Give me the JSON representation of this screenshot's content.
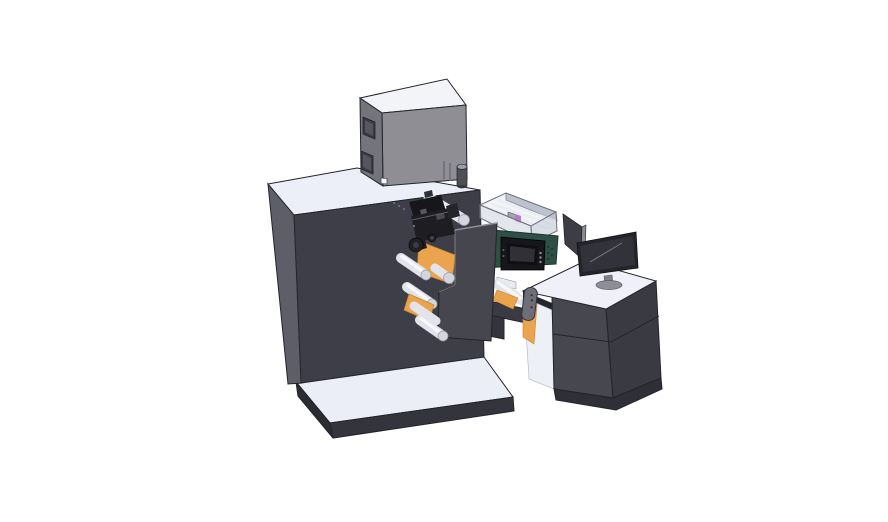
{
  "scene": {
    "type": "3d-cad-render",
    "description": "Isometric CAD render of a compact roll-fed label printing and converting machine: a large dark enclosure cabinet with web rollers and a print-head mechanism, a gray electronics box on top, a transparent guard module with linear rails over a teal control housing with an HMI touch panel, a web-transport bridge with an adjustment handle, and an operator desk cabinet with a desktop monitor, all standing on light base platforms.",
    "background": "#ffffff"
  },
  "colors": {
    "bg": "#ffffff",
    "outline": "#23232a",
    "cabinetFront": "#3e3e48",
    "cabinetSide": "#5e5e69",
    "cabinetTop": "#edeff8",
    "platformTop": "#eceef7",
    "platformSkirt": "#34343d",
    "platformSkirtDark": "#2b2b33",
    "boxTop": "#f3f4f8",
    "boxFront": "#8e8e94",
    "boxSide": "#74747b",
    "boxWindow": "#3a3a42",
    "boxWindowInner": "#565660",
    "boxVent": "#6e6e76",
    "beaconBody": "#4e4e57",
    "beaconTop": "#9aa0a8",
    "beaconBottom": "#3c3c44",
    "pillar": "#46464f",
    "pillarEdge": "#8f8f99",
    "roller": "#e3e4eb",
    "rollerHi": "#f7f8fc",
    "rollerCap": "#d4d5dd",
    "rollerEdge": "#9a9aa3",
    "orange": "#eaa44e",
    "orangeDark": "#c9812f",
    "green": "#2e4f45",
    "greenDark": "#1d332c",
    "greenTab": "#c8cdd6",
    "hmiFrame": "#17171b",
    "hmiBezel": "#101014",
    "hmiScreen": "#303036",
    "hmiButton": "#8a8a92",
    "mechDark": "#17171b",
    "mechMid": "#2f2f36",
    "mechLight": "#6b6b74",
    "encGlass": "#ccd3df",
    "encGlassSide": "#bfc7d4",
    "encBack": "#a9b1bd",
    "encRail": "#f4f6fa",
    "encFrame": "#70707a",
    "encCarriage": "#8f97a2",
    "encPurple": "#b558c6",
    "beamFill": "#3a3a43",
    "legFill": "#34343d",
    "deskTop": "#f0f1f8",
    "deskFrontLeft": "#474750",
    "deskFrontRight": "#3a3a43",
    "deskSkirt": "#2f2f37",
    "deskUnderside": "#26262e",
    "kickWhite": "#eef0f8",
    "monitorFrame": "#24242b",
    "monitorScreen": "#32323a",
    "monitorReflect": "#8a8a94",
    "monitorStand": "#80808a",
    "monitorBase": "#8e8e98",
    "panelDark": "#3d3d46",
    "panelSliver": "#8b8b94",
    "handleFill": "#6e6e77",
    "handleStroke": "#32323a",
    "deckSliver": "#e9ebf2"
  },
  "components": {
    "base_platform": {
      "label": "Machine base platform"
    },
    "main_cabinet": {
      "label": "Main machine cabinet"
    },
    "electronics_box": {
      "label": "Electronics box on cabinet top"
    },
    "beacon_cylinder": {
      "label": "Cylindrical post"
    },
    "top_roller": {
      "label": "Upper guide roller"
    },
    "guard_enclosure": {
      "label": "Transparent guard enclosure with linear rails"
    },
    "control_housing": {
      "label": "Teal control housing"
    },
    "hmi_panel": {
      "label": "HMI touch panel"
    },
    "bridge": {
      "label": "Web transport bridge"
    },
    "support_pillar": {
      "label": "Roller support pillar"
    },
    "web_mechanism": {
      "label": "Print-head and web roller mechanism"
    },
    "media_web": {
      "label": "Orange media web"
    },
    "adjustment_handle": {
      "label": "Adjustment handle"
    },
    "operator_desk": {
      "label": "Operator desk cabinet"
    },
    "monitor": {
      "label": "Desktop monitor"
    },
    "side_panel": {
      "label": "Folding side panel"
    }
  }
}
